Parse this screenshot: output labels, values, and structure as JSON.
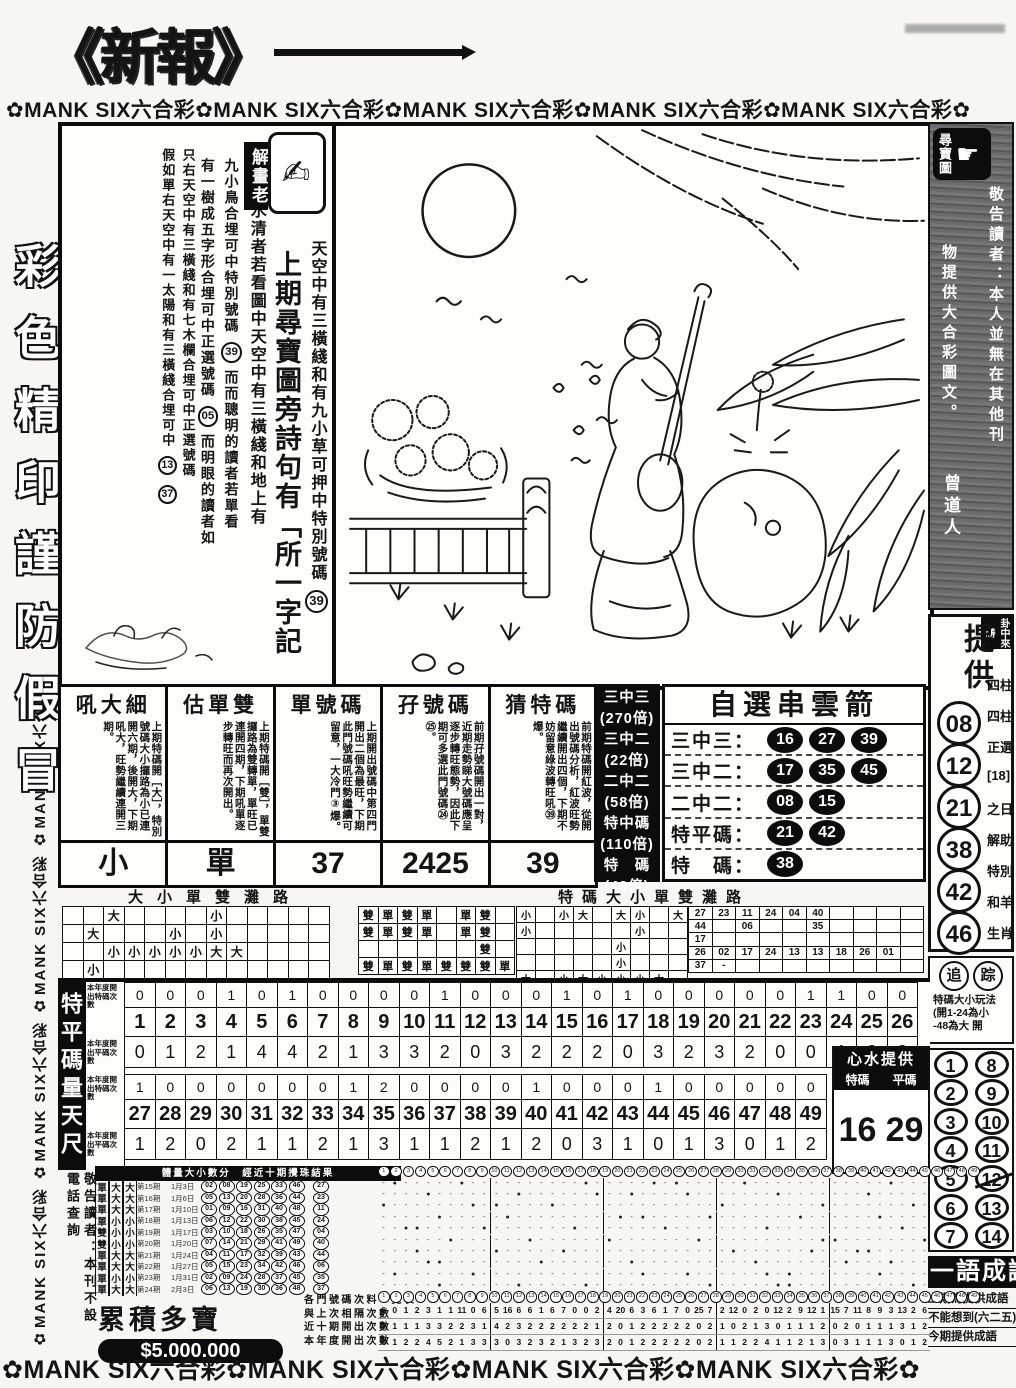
{
  "masthead": {
    "logo": "《新報》",
    "banner_top": "✿MANK SIX六合彩✿MANK SIX六合彩✿MANK SIX六合彩✿MANK SIX六合彩✿MANK SIX六合彩✿",
    "banner_bottom": "✿MANK SIX六合彩✿MANK SIX六合彩✿MANK SIX六合彩✿MANK SIX六合彩✿"
  },
  "left_margin": {
    "banner": "✿MANK SIX六合彩 ✿MANK SIX六合彩 ✿MANK SIX六合彩 ✿MANK SIX六合彩",
    "outline_text": "彩色精印謹防假冒"
  },
  "interp": {
    "badge": "解畫老",
    "icon": "hand-writing",
    "col_sky": "天空中有三橫綫和有九小草可押中特別號碼",
    "col_sky_circle": "39",
    "col_title": "上期尋寶圖旁詩句有「所一字記",
    "col_intro": "心水清者若看圖中天空中有三橫綫和地上有",
    "col_d_pre": "九小鳥合埋可中特別號碼",
    "col_d_circle": "39",
    "col_d_post": "而而聰明的讀者若單看",
    "col_e_pre": "有一樹成五字形合埋可中正選號碼",
    "col_e_circle": "05",
    "col_e_post": "而明眼的讀者如",
    "col_f": "只右天空中有三橫綫和有七木欄合埋可中正選號碼",
    "col_g": "假如單右天空中有一太陽和有三橫綫合埋可中",
    "col_g_c1": "13",
    "col_g_c2": "37"
  },
  "predictions": {
    "columns": [
      {
        "header": "吼大細",
        "body": "上期特碼開［大］，特別號碼大小攞路為小已連開六期，後開大，下期吼大，旺勢繼續連開三期。",
        "value": "小"
      },
      {
        "header": "估單雙",
        "body": "上期特碼開［雙］，單雙攞路為雙轉單，單旺已連開四期，下期吼單逐步轉旺而再次開出。",
        "value": "單"
      },
      {
        "header": "單號碼",
        "body": "上期開出號碼中第四門開出二個為最旺，下期此門號碼吼旺勢繼續可留意，一大冷門③爆。",
        "value": "37"
      },
      {
        "header": "孖號碼",
        "body": "前期孖號碼開出一對，近期走勢睇大號碼應呈逐步轉旺態勢，因此下期可多選此門號碼㉔㉕。",
        "value": "2425"
      },
      {
        "header": "猜特碼",
        "body": "前期特碼開紅波，從開出號碼分析，紅波旺勢繼續開出四個，下期不妨留意綠波轉旺吼㊴爆。",
        "value": "39"
      }
    ]
  },
  "odds_strip": {
    "lines": [
      "三中三",
      "(270倍)",
      "三中二",
      "(22倍)",
      "二中二",
      "(58倍)",
      "特中碼",
      "(110倍)",
      "特　碼",
      "(43倍)"
    ]
  },
  "arrow_box": {
    "title": "自選串雲箭",
    "rows": [
      {
        "label": "三中三",
        "numbers": [
          "16",
          "27",
          "39"
        ]
      },
      {
        "label": "三中二",
        "numbers": [
          "17",
          "35",
          "45"
        ]
      },
      {
        "label": "二中二",
        "numbers": [
          "08",
          "15"
        ]
      },
      {
        "label": "特平碼",
        "numbers": [
          "21",
          "42"
        ]
      },
      {
        "label": "特　碼",
        "numbers": [
          "38"
        ]
      }
    ]
  },
  "roads": {
    "left_title": "大小單雙灘路",
    "right_title": "特碼大小單雙灘路",
    "grid_daxiao": [
      [
        "",
        "",
        "大",
        "",
        "",
        "",
        "",
        "小",
        "",
        "",
        "",
        "",
        ""
      ],
      [
        "",
        "大",
        "",
        "",
        "",
        "小",
        "",
        "小",
        "",
        "",
        "",
        "",
        ""
      ],
      [
        "",
        "",
        "小",
        "小",
        "小",
        "小",
        "小",
        "大",
        "大",
        "",
        "",
        "",
        ""
      ],
      [
        "",
        "小",
        "",
        "",
        "",
        "",
        "",
        "",
        "",
        "",
        "",
        "",
        ""
      ]
    ],
    "grid_danshuang": [
      [
        "雙",
        "單",
        "雙",
        "單",
        "",
        "單",
        "雙",
        ""
      ],
      [
        "雙",
        "單",
        "雙",
        "單",
        "",
        "單",
        "雙",
        ""
      ],
      [
        "",
        "",
        "",
        "",
        "",
        "",
        "雙",
        ""
      ],
      [
        "雙",
        "單",
        "雙",
        "單",
        "雙",
        "雙",
        "雙",
        "單"
      ]
    ],
    "grid_te_daxiao": [
      [
        "小",
        "",
        "小",
        "大",
        "",
        "大",
        "小",
        "",
        "大"
      ],
      [
        "小",
        "",
        "",
        "",
        "",
        "",
        "小",
        "",
        ""
      ],
      [
        "",
        "",
        "",
        "",
        "",
        "小",
        "",
        "",
        ""
      ],
      [
        "",
        "",
        "",
        "",
        "",
        "小",
        "",
        "",
        ""
      ],
      [
        "大",
        "",
        "小",
        "大",
        "小",
        "小",
        "小",
        "大",
        ""
      ]
    ],
    "grid_te_numbers": [
      [
        "27",
        "23",
        "11",
        "24",
        "04",
        "40",
        "",
        "",
        "",
        ""
      ],
      [
        "44",
        "",
        "06",
        "",
        "",
        "35",
        "",
        "",
        "",
        ""
      ],
      [
        "17",
        "",
        "",
        "",
        "",
        "",
        "",
        "",
        "",
        ""
      ],
      [
        "26",
        "02",
        "17",
        "24",
        "13",
        "13",
        "18",
        "26",
        "01",
        ""
      ],
      [
        "37",
        "-",
        "",
        "",
        "",
        "",
        "",
        "",
        "",
        ""
      ]
    ]
  },
  "scale_table": {
    "side_label": "特平碼量天尺",
    "row_label_te": "本年度開出特碼次數",
    "row_label_ping": "本年度開出平碼次數",
    "numbers_top": [
      1,
      2,
      3,
      4,
      5,
      6,
      7,
      8,
      9,
      10,
      11,
      12,
      13,
      14,
      15,
      16,
      17,
      18,
      19,
      20,
      21,
      22,
      23,
      24,
      25,
      26
    ],
    "te_top": [
      0,
      0,
      0,
      1,
      0,
      1,
      0,
      0,
      0,
      0,
      1,
      0,
      0,
      0,
      1,
      0,
      1,
      0,
      0,
      0,
      0,
      0,
      1,
      1,
      0,
      0
    ],
    "ping_top": [
      0,
      1,
      2,
      1,
      4,
      4,
      2,
      1,
      3,
      3,
      2,
      0,
      3,
      2,
      2,
      2,
      0,
      3,
      2,
      3,
      2,
      0,
      0,
      1,
      2,
      2
    ],
    "numbers_bottom": [
      27,
      28,
      29,
      30,
      31,
      32,
      33,
      34,
      35,
      36,
      37,
      38,
      39,
      40,
      41,
      42,
      43,
      44,
      45,
      46,
      47,
      48,
      49
    ],
    "te_bottom": [
      1,
      0,
      0,
      0,
      0,
      0,
      0,
      1,
      2,
      0,
      0,
      0,
      0,
      1,
      0,
      0,
      0,
      1,
      0,
      0,
      0,
      0,
      0
    ],
    "ping_bottom": [
      1,
      2,
      0,
      2,
      1,
      1,
      2,
      1,
      3,
      1,
      1,
      2,
      1,
      2,
      0,
      3,
      1,
      0,
      1,
      3,
      0,
      1,
      2
    ],
    "tip_box": {
      "title": "心水提供",
      "col1": "特碼",
      "col2": "平碼",
      "val1": "16",
      "val2": "29"
    }
  },
  "history": {
    "notice": "敬告讀者：本刊不設電話查詢",
    "header": "體量大小數分　經近十期攪珠結果",
    "draws": [
      {
        "odd": "單",
        "size1": "大",
        "size2": "大",
        "period": "第15期",
        "date": "1月3日",
        "balls": [
          2,
          8,
          19,
          25,
          33,
          46
        ],
        "special": 27
      },
      {
        "odd": "單",
        "size1": "大",
        "size2": "大",
        "period": "第16期",
        "date": "1月6日",
        "balls": [
          5,
          13,
          20,
          28,
          36,
          44
        ],
        "special": 23
      },
      {
        "odd": "單",
        "size1": "大",
        "size2": "大",
        "period": "第17期",
        "date": "1月10日",
        "balls": [
          1,
          9,
          16,
          31,
          40,
          48
        ],
        "special": 11
      },
      {
        "odd": "單",
        "size1": "小",
        "size2": "小",
        "period": "第18期",
        "date": "1月13日",
        "balls": [
          6,
          12,
          22,
          30,
          38,
          45
        ],
        "special": 24
      },
      {
        "odd": "雙",
        "size1": "小",
        "size2": "小",
        "period": "第19期",
        "date": "1月17日",
        "balls": [
          3,
          10,
          18,
          26,
          35,
          47
        ],
        "special": 4
      },
      {
        "odd": "雙",
        "size1": "小",
        "size2": "小",
        "period": "第20期",
        "date": "1月20日",
        "balls": [
          7,
          14,
          21,
          29,
          41,
          49
        ],
        "special": 40
      },
      {
        "odd": "單",
        "size1": "大",
        "size2": "大",
        "period": "第21期",
        "date": "1月24日",
        "balls": [
          4,
          11,
          17,
          32,
          39,
          43
        ],
        "special": 44
      },
      {
        "odd": "單",
        "size1": "大",
        "size2": "大",
        "period": "第22期",
        "date": "1月27日",
        "balls": [
          5,
          15,
          23,
          34,
          42,
          46
        ],
        "special": 6
      },
      {
        "odd": "單",
        "size1": "小",
        "size2": "小",
        "period": "第23期",
        "date": "1月31日",
        "balls": [
          2,
          9,
          24,
          28,
          37,
          45
        ],
        "special": 35
      },
      {
        "odd": "單",
        "size1": "大",
        "size2": "大",
        "period": "第24期",
        "date": "2月3日",
        "balls": [
          6,
          13,
          19,
          30,
          36,
          48
        ],
        "special": 37
      }
    ],
    "jackpot_title": "累積多寶",
    "jackpot_amount": "$5.000.000",
    "counts_labels": [
      "各門號碼次料一覽表",
      "與上次相隔次數",
      "近十期開出次數",
      "本年度開出次數"
    ],
    "gap_counts": [
      6,
      0,
      1,
      2,
      3,
      1,
      1,
      11,
      0,
      6,
      5,
      16,
      6,
      6,
      1,
      6,
      7,
      0,
      0,
      2,
      4,
      20,
      6,
      3,
      6,
      1,
      7,
      0,
      25,
      7,
      2,
      12,
      0,
      2,
      0,
      12,
      2,
      9,
      12,
      1,
      15,
      7,
      11,
      8,
      9,
      3,
      13,
      2,
      6
    ],
    "recent_counts": [
      0,
      1,
      1,
      1,
      3,
      3,
      2,
      2,
      3,
      1,
      4,
      2,
      3,
      2,
      2,
      2,
      2,
      2,
      2,
      1,
      2,
      0,
      1,
      2,
      2,
      2,
      2,
      2,
      0,
      2,
      1,
      0,
      2,
      1,
      3,
      0,
      1,
      1,
      1,
      2,
      0,
      2,
      0,
      1,
      1,
      1,
      3,
      1,
      2
    ],
    "year_counts": [
      0,
      1,
      2,
      2,
      4,
      5,
      2,
      1,
      3,
      3,
      3,
      0,
      3,
      2,
      3,
      2,
      1,
      3,
      2,
      3,
      2,
      0,
      1,
      2,
      2,
      2,
      2,
      2,
      0,
      2,
      1,
      1,
      2,
      2,
      4,
      1,
      1,
      2,
      1,
      3,
      0,
      3,
      1,
      1,
      1,
      3,
      0,
      1,
      2
    ]
  },
  "sidebar": {
    "treasure_badge": "尋寶圖",
    "notice_col_right": "敬告讀者：本人並無在其他刊",
    "notice_col_left": "物提供大合彩圖文。",
    "signature": "曾道人",
    "corner_badge": "卦中來勝",
    "provide_title": "提供",
    "provide_numbers": [
      "08",
      "12",
      "21",
      "38",
      "42",
      "46"
    ],
    "provide_side_texts": [
      "四柱",
      "四柱",
      "正選",
      "[18]",
      "之日",
      "解助",
      "特別",
      "和羊",
      "生肖"
    ],
    "chase_circles": [
      "追",
      "踪"
    ],
    "chase_line1": "特碼大小玩法",
    "chase_line2": "(開1-24為小",
    "chase_line3": "-48為大 開",
    "pairs": [
      [
        "1",
        "8"
      ],
      [
        "2",
        "9"
      ],
      [
        "3",
        "10"
      ],
      [
        "4",
        "11"
      ],
      [
        "5",
        "12"
      ],
      [
        "6",
        "13"
      ],
      [
        "7",
        "14"
      ]
    ],
    "struck_number": "12",
    "idiom_banner": "一語成讖",
    "idiom_lines": [
      "上期為提供成語",
      "不能想到(六二五)",
      "今期提供成語"
    ]
  },
  "colors": {
    "ink": "#141414",
    "paper": "#f7f6f2",
    "highlight": "#0c0c0c"
  }
}
